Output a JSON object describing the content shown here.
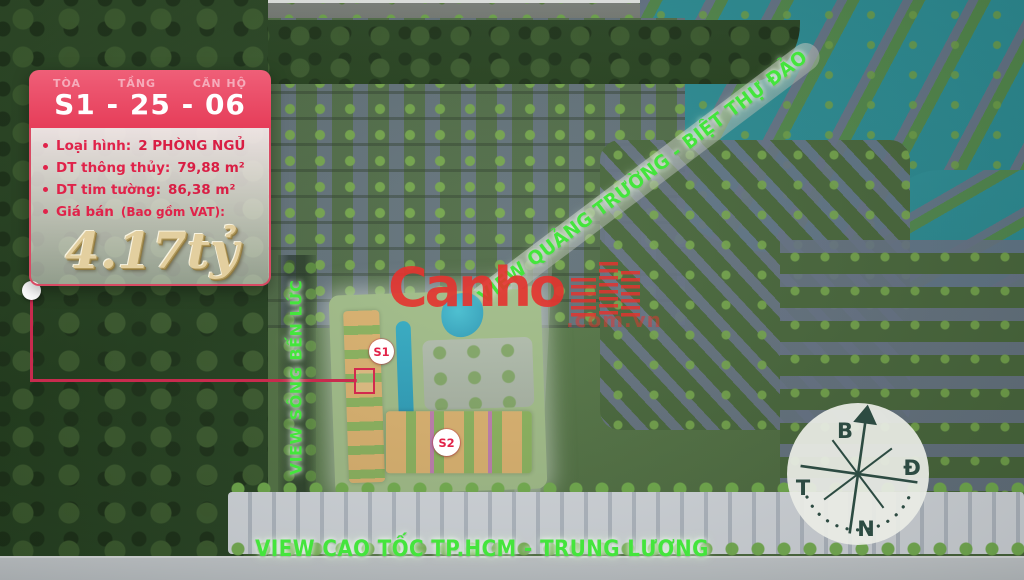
{
  "listing_card": {
    "header": {
      "building_label": "TÒA",
      "floor_label": "TẦNG",
      "unit_label": "CĂN HỘ",
      "code": "S1 - 25 - 06"
    },
    "details": [
      {
        "label": "Loại hình:",
        "value": "2 PHÒNG NGỦ"
      },
      {
        "label": "DT thông thủy:",
        "value": "79,88 m²"
      },
      {
        "label": "DT tim tường:",
        "value": "86,38 m²"
      },
      {
        "label": "Giá bán",
        "suffix": "(Bao gồm VAT):"
      }
    ],
    "price": "4.17tỷ"
  },
  "map_labels": {
    "diagonal": "VIEW QUẢNG TRƯỜNG - BIỆT THỰ ĐẢO",
    "vertical": "VIEW SÔNG BẾN LỨC",
    "bottom": "VIEW CAO TỐC TP.HCM - TRUNG LƯƠNG"
  },
  "building_markers": {
    "s1": "S1",
    "s2": "S2"
  },
  "watermark": {
    "brand": "Canho",
    "domain": ".com.vn"
  },
  "compass": {
    "north": "B",
    "east": "Đ",
    "west": "T",
    "south": "N"
  },
  "colors": {
    "card_red": "#e63d59",
    "detail_text_red": "#e0234a",
    "price_gold": "#e3cf9f",
    "label_green": "#44e53c",
    "watermark_red": "#e5332e",
    "water_teal": "#2d8f96"
  }
}
